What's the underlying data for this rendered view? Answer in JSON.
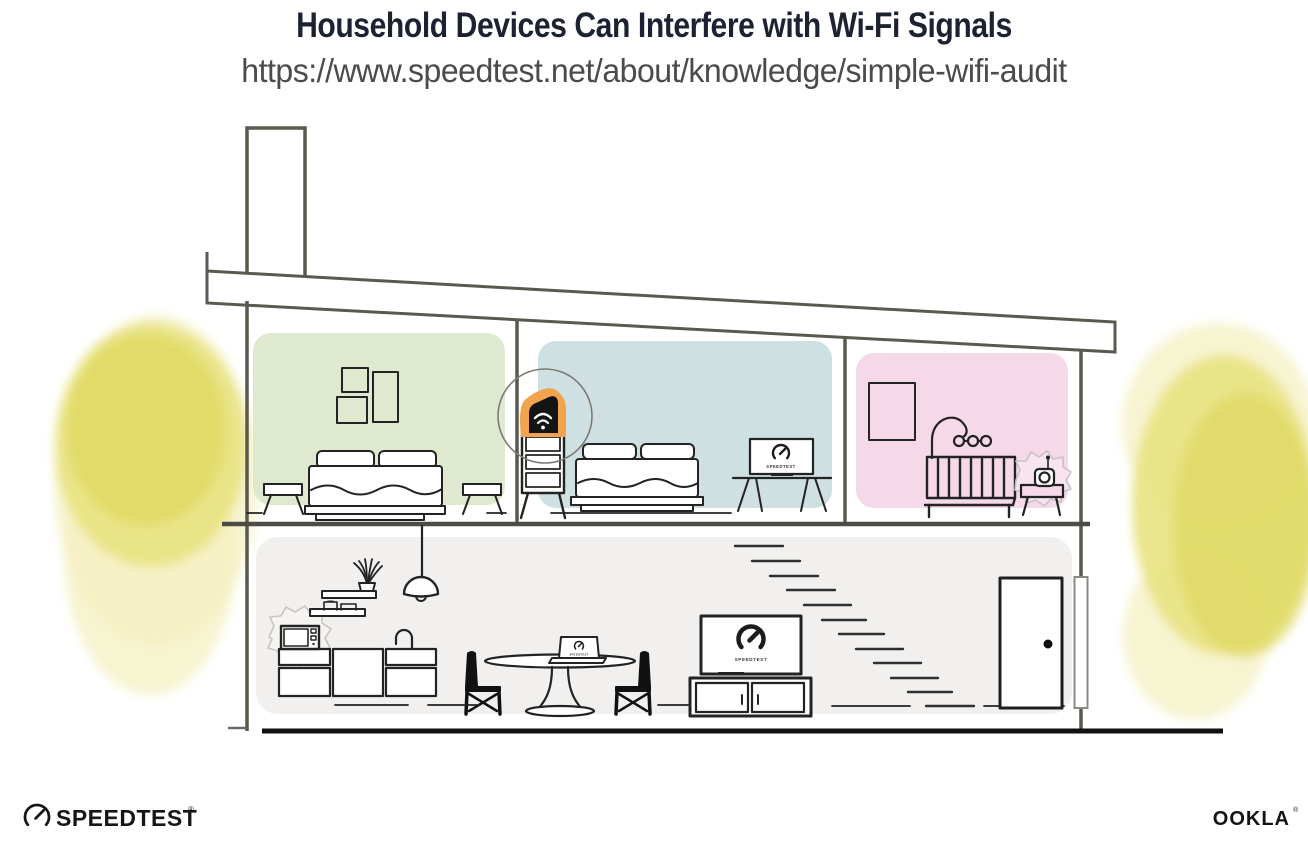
{
  "header": {
    "title": "Household Devices Can Interfere with Wi-Fi Signals",
    "url": "https://www.speedtest.net/about/knowledge/simple-wifi-audit"
  },
  "screens": {
    "bedroom_monitor_label": "SPEEDTEST",
    "living_room_tv_label": "SPEEDTEST",
    "dining_laptop_label": "SPEEDTEST"
  },
  "footer": {
    "speedtest_wordmark": "SPEEDTEST",
    "speedtest_trademark": "®",
    "ookla_wordmark": "OOKLA",
    "ookla_trademark": "®"
  },
  "colors": {
    "title_ink": "#1d2232",
    "url_ink": "#4b4b4b",
    "bedroom_left_wall": "#dfe9d0",
    "bedroom_middle_wall": "#cfe0e3",
    "nursery_wall": "#f5d9e8",
    "ground_floor_wall": "#f1f0ee",
    "router_highlight_orange": "#f2a34e",
    "foliage_light": "#f3efbe",
    "foliage_mid": "#e9e282",
    "foliage_deep": "#e0d964",
    "structure_gray": "#5a594f",
    "ink": "#232323",
    "ground_ink": "#111111"
  }
}
